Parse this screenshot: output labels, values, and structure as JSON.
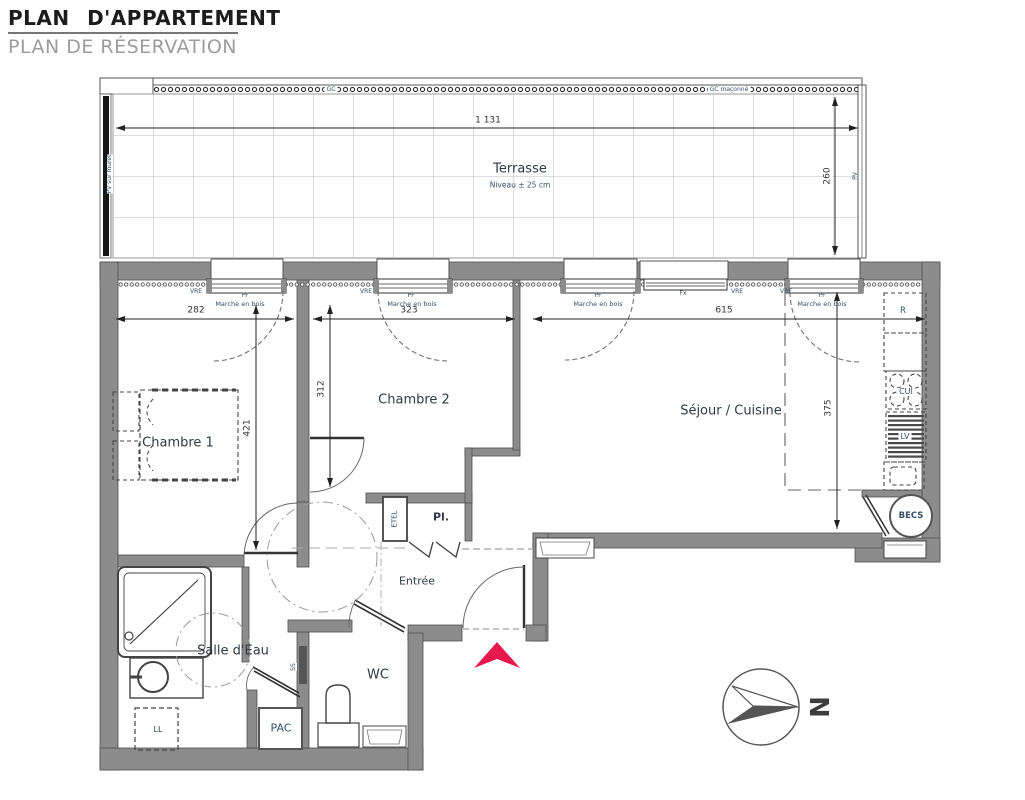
{
  "header": {
    "title": "PLAN D'APPARTEMENT",
    "subtitle": "PLAN DE RÉSERVATION"
  },
  "terrace": {
    "name": "Terrasse",
    "level_note": "Niveau ± 25 cm",
    "dim_width": "1 131",
    "dim_depth": "260",
    "gc": "GC",
    "gc_masonry": "GC maçonné",
    "pv": "PV",
    "pv_muret": "PV sur muret"
  },
  "rooms": {
    "bedroom1": "Chambre 1",
    "bedroom2": "Chambre 2",
    "living_kitchen": "Séjour / Cuisine",
    "entry": "Entrée",
    "bathroom": "Salle d'Eau",
    "wc": "WC",
    "closet": "Pl."
  },
  "dims": {
    "bedroom1_width": "282",
    "bedroom2_width": "323",
    "living_width": "615",
    "bedroom2_depth": "312",
    "bedroom1_depth": "421",
    "living_depth": "375"
  },
  "openings": {
    "vre": "VRE",
    "pf": "PF",
    "wood_step": "Marche en bois",
    "fixed": "Fx"
  },
  "equipment": {
    "fridge": "R",
    "cooktop": "CUI",
    "dishwasher": "LV",
    "water_heater": "BECS",
    "heat_pump": "PAC",
    "washer": "LL",
    "towel_rail": "SS",
    "elec_panel": "ETEL"
  },
  "compass": {
    "north": "N"
  },
  "colors": {
    "wall": "#8c8c8c",
    "line": "#444444",
    "entrance_arrow": "#e8194e",
    "annotation": "#35506b",
    "dimension": "#333333"
  }
}
